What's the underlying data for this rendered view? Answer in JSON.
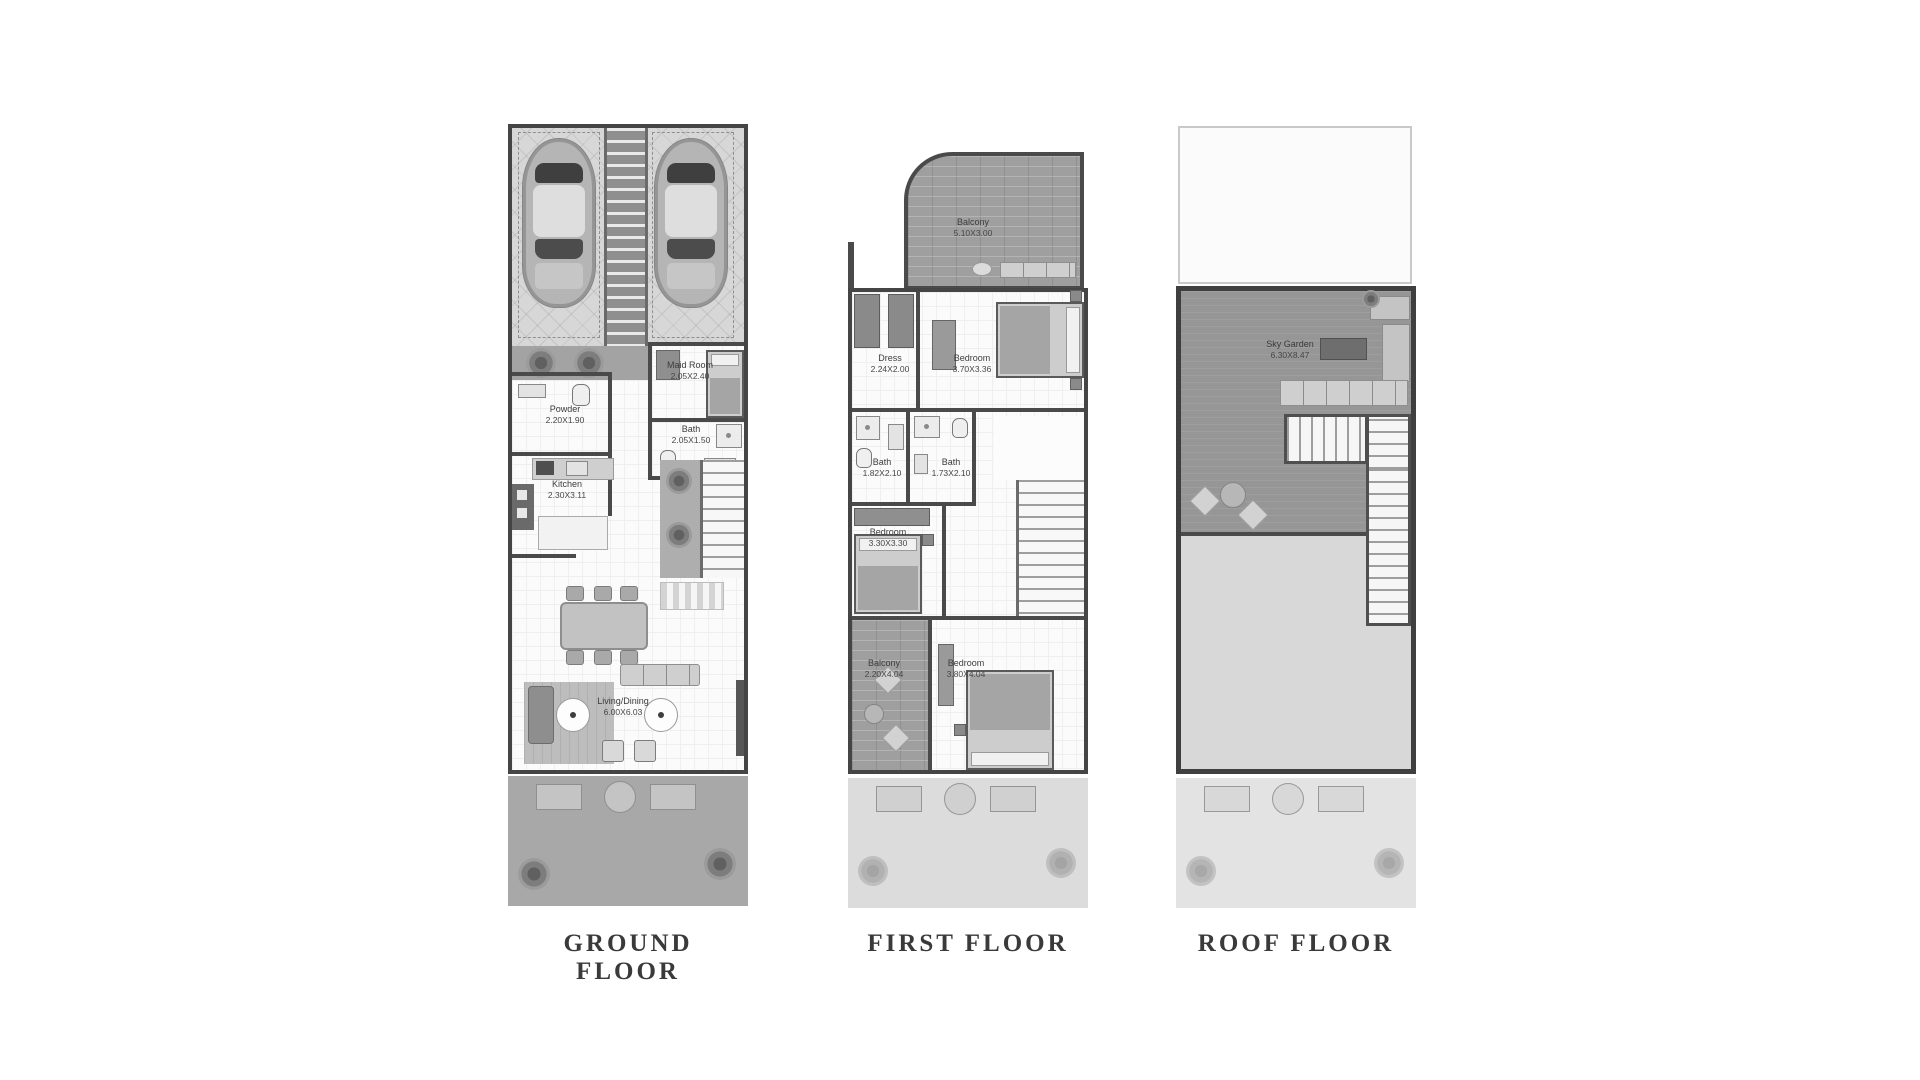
{
  "page": {
    "background": "#ffffff",
    "description": "Three townhouse floor plans side by side"
  },
  "colors": {
    "wall": "#454545",
    "floor": "#fbfbfb",
    "garage": "#d7d7d7",
    "wood_deck": "#9f9f9f",
    "sky_deck": "#969696",
    "garden_ground": "#a8a8a8",
    "garden_upper": "#dcdcdc",
    "title_text": "#3a3a3a",
    "label_text": "#3c3c3c"
  },
  "floors": [
    {
      "id": "ground-floor",
      "title": "GROUND FLOOR",
      "rooms": [
        {
          "name": "Maid Room",
          "dims": "2.05X2.40"
        },
        {
          "name": "Powder",
          "dims": "2.20X1.90"
        },
        {
          "name": "Bath",
          "dims": "2.05X1.50"
        },
        {
          "name": "Kitchen",
          "dims": "2.30X3.11"
        },
        {
          "name": "Living/Dining",
          "dims": "6.00X6.03"
        }
      ]
    },
    {
      "id": "first-floor",
      "title": "FIRST FLOOR",
      "rooms": [
        {
          "name": "Balcony",
          "dims": "5.10X3.00"
        },
        {
          "name": "Dress",
          "dims": "2.24X2.00"
        },
        {
          "name": "Bedroom",
          "dims": "3.70X3.36"
        },
        {
          "name": "Bath",
          "dims": "1.82X2.10"
        },
        {
          "name": "Bath",
          "dims": "1.73X2.10"
        },
        {
          "name": "Bedroom",
          "dims": "3.30X3.30"
        },
        {
          "name": "Balcony",
          "dims": "2.20X4.04"
        },
        {
          "name": "Bedroom",
          "dims": "3.80X4.04"
        }
      ]
    },
    {
      "id": "roof-floor",
      "title": "ROOF FLOOR",
      "rooms": [
        {
          "name": "Sky Garden",
          "dims": "6.30X8.47"
        }
      ]
    }
  ]
}
